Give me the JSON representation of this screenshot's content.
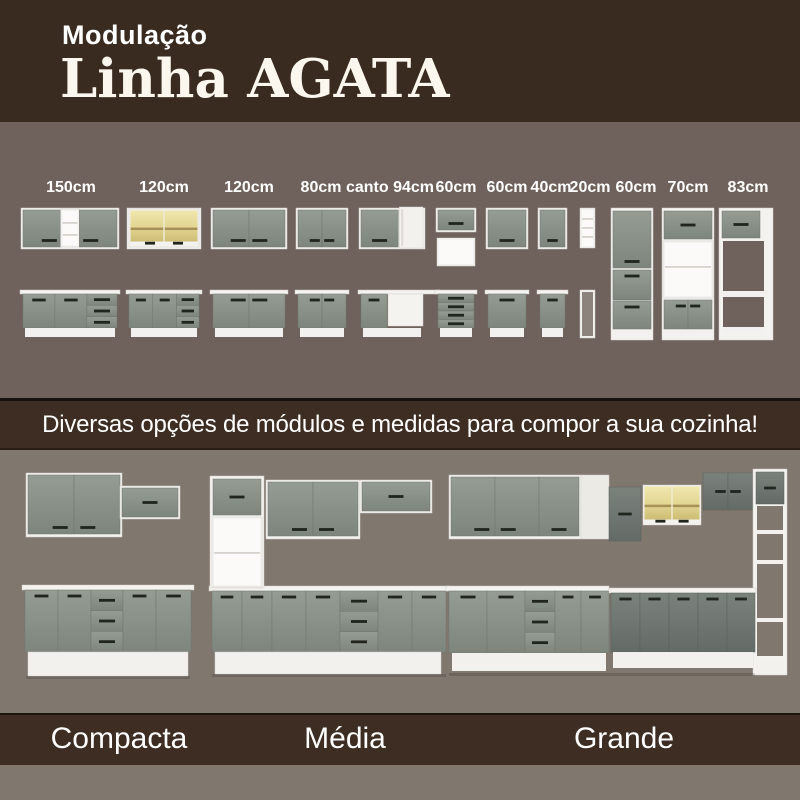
{
  "header": {
    "kicker": "Modulação",
    "title": "Linha AGATA"
  },
  "banner": {
    "text": "Diversas opções de módulos e medidas para compor a sua cozinha!"
  },
  "modules": [
    {
      "label": "150cm",
      "upper": "door-shelf-door",
      "base": "door-door-drawers"
    },
    {
      "label": "120cm",
      "upper": "glass-2-doors",
      "base": "door-door-drawers"
    },
    {
      "label": "120cm",
      "upper": "2-doors",
      "base": "2-doors"
    },
    {
      "label": "80cm",
      "upper": "2-doors",
      "base": "2-doors"
    },
    {
      "label": "canto 94cm",
      "upper": "corner-door-panel",
      "base": "corner-door-panel-counter"
    },
    {
      "label": "60cm",
      "upper": "flap-door-niche",
      "base": "4-drawers"
    },
    {
      "label": "60cm",
      "upper": "1-door",
      "base": "1-door"
    },
    {
      "label": "40cm",
      "upper": "1-door",
      "base": "1-door"
    },
    {
      "label": "20cm",
      "upper": "open-shelf-4",
      "base": "open-shelf-tall"
    },
    {
      "label": "60cm",
      "tall": "pantry-3-doors"
    },
    {
      "label": "70cm",
      "tall": "oven-tower"
    },
    {
      "label": "83cm",
      "tall": "fridge-surround"
    }
  ],
  "kitchens": [
    {
      "name": "Compacta",
      "type": "straight-small"
    },
    {
      "name": "Média",
      "type": "straight-with-tower"
    },
    {
      "name": "Grande",
      "type": "l-shaped-corner"
    }
  ],
  "colors": {
    "header_bg": "#3a2b20",
    "banner_bg": "#3e2d22",
    "top_bg": "#6f625d",
    "bottom_bg": "#80776f",
    "door_gray": "#858d85",
    "door_dark_gray": "#6d746e",
    "glass_yellow": "#e3d58f",
    "carcass_white": "#f3f2ef",
    "handle_dark": "#20251e",
    "text_white": "#ffffff",
    "title_cream": "#fbf7ee"
  }
}
